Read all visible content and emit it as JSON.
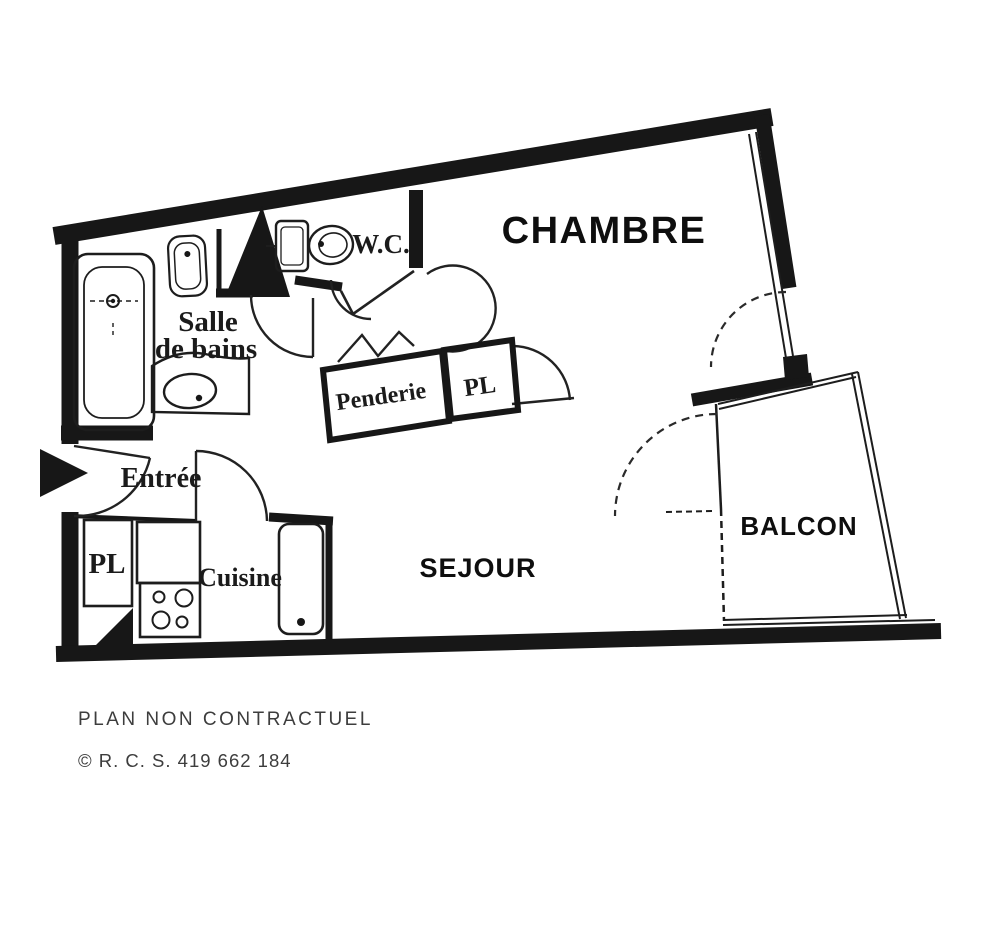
{
  "colors": {
    "wall": "#171717",
    "background": "#ffffff",
    "room_label": "#0e0e0e",
    "caption_text": "#3d3d3d"
  },
  "rooms": {
    "chambre": {
      "label": "CHAMBRE"
    },
    "wc": {
      "label": "W.C."
    },
    "salle_de_bains": {
      "line1": "Salle",
      "line2": "de bains"
    },
    "entree": {
      "label": "Entrée"
    },
    "penderie": {
      "label": "Penderie"
    },
    "placard_hall": {
      "label": "PL"
    },
    "cuisine": {
      "label": "Cuisine"
    },
    "placard_cuisine": {
      "label": "PL"
    },
    "sejour": {
      "label": "SEJOUR"
    },
    "balcon": {
      "label": "BALCON"
    }
  },
  "footer": {
    "disclaimer": "PLAN NON CONTRACTUEL",
    "registration": "© R. C. S. 419 662 184"
  }
}
